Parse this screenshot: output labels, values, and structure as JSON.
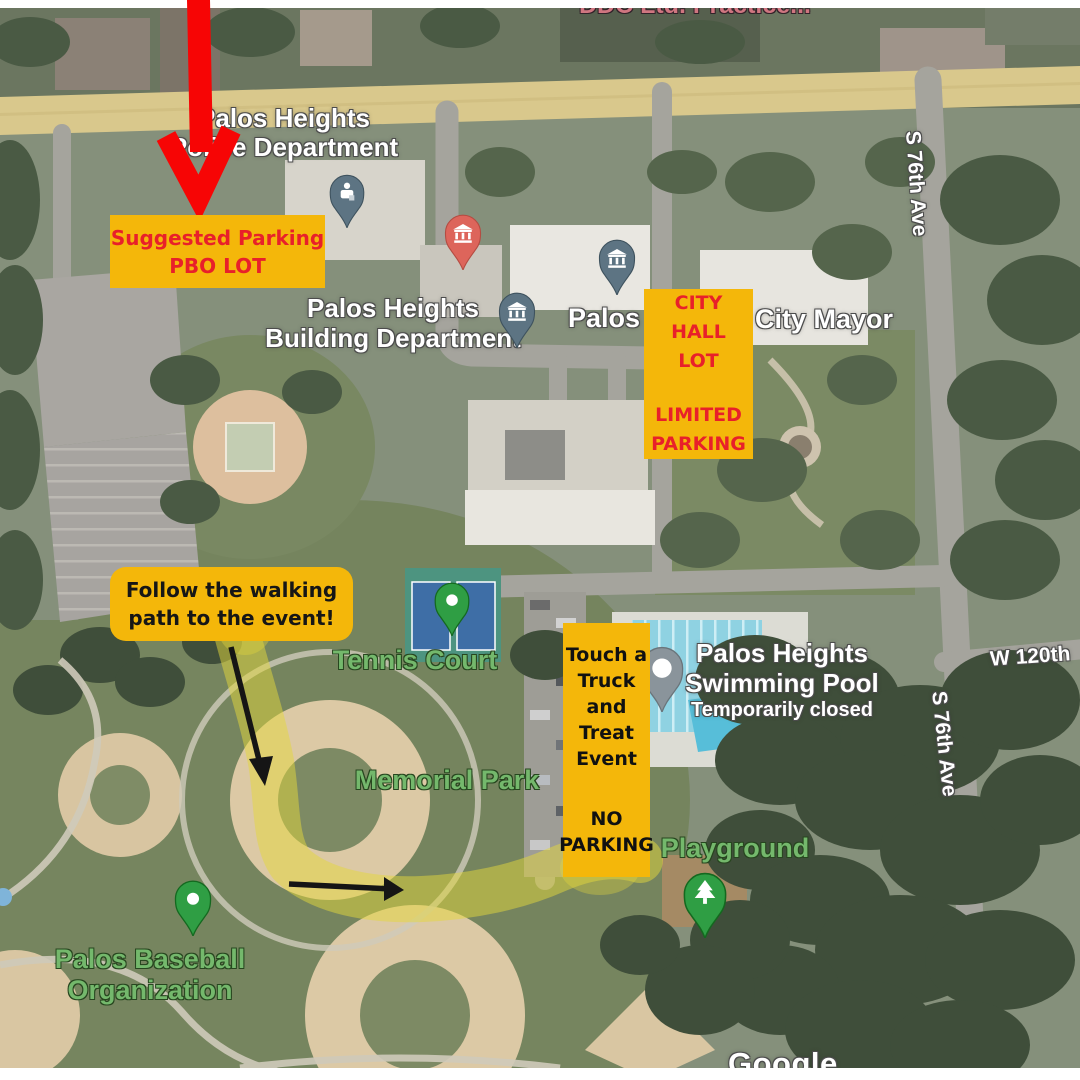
{
  "boxes": {
    "suggested_parking": {
      "lines": [
        "Suggested Parking",
        "PBO LOT"
      ]
    },
    "city_hall": {
      "lines_top": [
        "CITY HALL",
        "LOT"
      ],
      "lines_bottom": [
        "LIMITED",
        "PARKING"
      ]
    },
    "follow_path": {
      "lines": [
        "Follow the walking",
        "path to the event!"
      ]
    },
    "event": {
      "lines_top": [
        "Touch a",
        "Truck",
        "and",
        "Treat",
        "Event"
      ],
      "lines_bottom": [
        "NO",
        "PARKING"
      ]
    }
  },
  "map_labels": {
    "business_top": "DDC Ltd. Practice...",
    "police_line1": "Palos Heights",
    "police_line2": "Police Department",
    "building_line1": "Palos Heights",
    "building_line2": "Building Department",
    "palos_partial": "Palos",
    "city_mayor": "City Mayor",
    "tennis_court": "Tennis Court",
    "memorial_park": "Memorial Park",
    "pool_line1": "Palos Heights",
    "pool_line2": "Swimming Pool",
    "pool_status": "Temporarily closed",
    "playground": "Playground",
    "baseball_line1": "Palos Baseball",
    "baseball_line2": "Organization",
    "street_76th_top": "S 76th Ave",
    "street_76th_bottom": "S 76th Ave",
    "street_120th": "W 120th",
    "watermark": "Google"
  },
  "colors": {
    "annotation_yellow": "#f4b70a",
    "annotation_red": "#e8202a",
    "arrow_red": "#f70505",
    "path_highlight": "#e4d83c",
    "pin_green": "#2f9e44",
    "pin_slate": "#5d7483",
    "pin_salmon": "#dd655b",
    "pin_gray": "#8a949b",
    "road_yellow": "#d9c88c",
    "label_green": "#74b86c"
  }
}
